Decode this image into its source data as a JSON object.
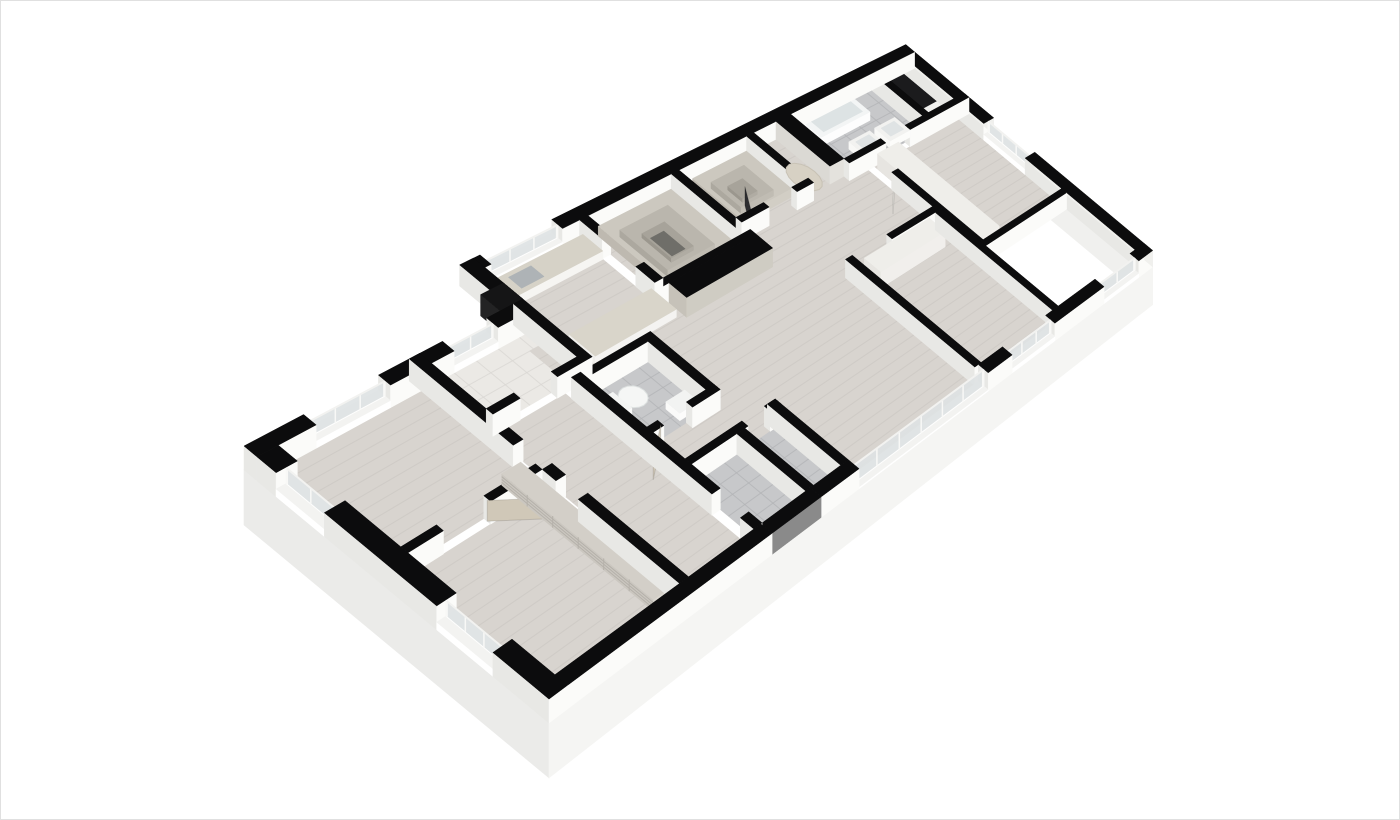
{
  "meta": {
    "title": "3D isometric apartment floor plan render"
  },
  "canvas": {
    "width": 1400,
    "height": 820,
    "background": "#ffffff",
    "frame_color": "#e0e0e0"
  },
  "projection": {
    "matrix": {
      "a": 75.56,
      "b": 40.25,
      "c": 186.7,
      "d": -22.32,
      "e": 33.44,
      "f": 422.3,
      "g": 0.0306,
      "h": 0.00019
    },
    "wall_px": 24,
    "slab_px": 55
  },
  "palette": {
    "cap": "#0c0c0d",
    "faceL": "#e8e8e5",
    "faceF": "#fbfbf9",
    "faceR": "#f0f0ed",
    "wood": "#d8d4cf",
    "plank": "#c6c2bd",
    "tileG": "#c7c8ca",
    "groutG": "#b3b4b6",
    "tileW": "#ebe9e5",
    "groutW": "#d9d7d3",
    "dark": "#1b1b1d",
    "glass": "#dfe3e4",
    "stone": "#d6d2c7",
    "marble": "#d9d5ca",
    "greige": "#c6c2b9",
    "wooddoor": "#d0c8b8",
    "darkpanel": "#2c2c2f"
  },
  "skirts": [
    {
      "name": "slab-left",
      "edge": [
        0,
        1.4,
        0,
        9
      ],
      "fill": "#ebebe9"
    },
    {
      "name": "slab-right",
      "edge": [
        15,
        0,
        15,
        9
      ],
      "fill": "#f0f0ee"
    },
    {
      "name": "slab-front",
      "edge": [
        0,
        9,
        15,
        9
      ],
      "fill": "#f5f5f3"
    }
  ],
  "floors": [
    {
      "name": "bedroom-left-floor",
      "r": [
        0.32,
        1.72,
        2.62,
        4.8
      ],
      "fill": "wood",
      "stripes": 0.27
    },
    {
      "name": "den-floor",
      "r": [
        0.32,
        4.98,
        2.62,
        8.68
      ],
      "fill": "wood",
      "stripes": 0.27
    },
    {
      "name": "laundry-floor",
      "r": [
        2.8,
        1.72,
        4.5,
        3.2
      ],
      "fill": "tileW",
      "grid": 0.4
    },
    {
      "name": "corridor-floor",
      "r": [
        2.8,
        3.38,
        4.15,
        8.68
      ],
      "fill": "wood",
      "stripes": 0.27
    },
    {
      "name": "kitchen-floor",
      "r": [
        4.55,
        0.32,
        6.55,
        2.12
      ],
      "fill": "wood",
      "stripes": 0.27
    },
    {
      "name": "living-floor",
      "r": [
        4.33,
        2.12,
        12.0,
        8.68
      ],
      "fill": "wood",
      "stripes": 0.27
    },
    {
      "name": "closet-a-floor",
      "r": [
        6.73,
        0.32,
        8.55,
        2.57
      ],
      "fill": "wood",
      "stripes": 0.33
    },
    {
      "name": "closet-b-floor",
      "r": [
        8.73,
        0.32,
        10.35,
        2.12
      ],
      "fill": "wood",
      "stripes": 0.33
    },
    {
      "name": "hall-floor",
      "r": [
        10.53,
        0.32,
        11.1,
        2.12
      ],
      "fill": "wood",
      "stripes": 0.33
    },
    {
      "name": "bath-main-floor",
      "r": [
        11.48,
        0.32,
        13.72,
        2.12
      ],
      "fill": "tileG",
      "grid": 0.42
    },
    {
      "name": "void-floor",
      "r": [
        13.9,
        0.32,
        14.68,
        1.5
      ],
      "fill": "dark"
    },
    {
      "name": "bedroom-right-floor",
      "r": [
        12.18,
        2.3,
        14.68,
        6.02
      ],
      "fill": "wood",
      "stripes": 0.27
    },
    {
      "name": "bedroom-mid-floor",
      "r": [
        9.78,
        4.68,
        11.92,
        8.68
      ],
      "fill": "wood",
      "stripes": 0.27
    },
    {
      "name": "bath2-floor",
      "r": [
        4.33,
        3.73,
        5.57,
        5.42
      ],
      "fill": "tileG",
      "grid": 0.35
    },
    {
      "name": "entry1-floor",
      "r": [
        4.33,
        6.68,
        5.3,
        8.68
      ],
      "fill": "tileG",
      "grid": 0.35
    },
    {
      "name": "entry2-floor",
      "r": [
        5.48,
        6.68,
        6.12,
        8.68
      ],
      "fill": "tileG",
      "grid": 0.35
    }
  ],
  "walls": [
    {
      "name": "ext-back-kitchen-left",
      "r": [
        4.55,
        0,
        4.8,
        0.32
      ]
    },
    {
      "name": "ext-back-main",
      "r": [
        6.2,
        0,
        15,
        0.32
      ]
    },
    {
      "name": "ext-backleft-a",
      "r": [
        0,
        1.4,
        0.9,
        1.72
      ]
    },
    {
      "name": "ext-backleft-b",
      "r": [
        2.1,
        1.4,
        3.2,
        1.72
      ]
    },
    {
      "name": "ext-backleft-c",
      "r": [
        4.0,
        1.4,
        4.55,
        1.72
      ]
    },
    {
      "name": "ext-step-wall",
      "r": [
        4.42,
        0,
        4.68,
        1.4
      ]
    },
    {
      "name": "ext-left-a",
      "r": [
        0,
        1.72,
        0.32,
        2.2
      ]
    },
    {
      "name": "ext-left-b",
      "r": [
        0,
        3.4,
        0.32,
        6.2
      ]
    },
    {
      "name": "ext-left-c",
      "r": [
        0,
        7.6,
        0.32,
        9
      ]
    },
    {
      "name": "ext-right-a",
      "r": [
        14.68,
        0.32,
        15,
        3.2
      ],
      "fR": true
    },
    {
      "name": "ext-right-b",
      "r": [
        14.68,
        4.7,
        15,
        9
      ],
      "fR": true
    },
    {
      "name": "ext-front-a",
      "r": [
        0,
        8.68,
        4.3,
        9
      ]
    },
    {
      "name": "entry-door-unit",
      "r": [
        4.3,
        8.68,
        5.4,
        9
      ],
      "fF": "#8a8a8a"
    },
    {
      "name": "ext-front-b",
      "r": [
        5.4,
        8.68,
        6.3,
        9
      ]
    },
    {
      "name": "ext-front-c",
      "r": [
        9.7,
        8.68,
        10.4,
        9
      ]
    },
    {
      "name": "ext-front-d",
      "r": [
        11.7,
        8.68,
        13.3,
        9
      ]
    },
    {
      "name": "ext-front-e",
      "r": [
        14.5,
        8.68,
        15,
        9
      ],
      "fR": true
    },
    {
      "name": "bed1-right-wall",
      "r": [
        2.62,
        1.4,
        2.8,
        4.2
      ]
    },
    {
      "name": "den-right-wall-a",
      "r": [
        2.62,
        4.98,
        2.8,
        5.35
      ]
    },
    {
      "name": "den-right-wall-b",
      "r": [
        2.62,
        5.95,
        2.8,
        8.68
      ]
    },
    {
      "name": "bed1-bottom-a",
      "r": [
        0.32,
        4.8,
        0.9,
        4.98
      ]
    },
    {
      "name": "bed1-bottom-b",
      "r": [
        1.7,
        4.8,
        2.62,
        4.98
      ]
    },
    {
      "name": "laundry-right-wall",
      "r": [
        4.5,
        1.4,
        4.68,
        3.2
      ]
    },
    {
      "name": "laundry-bottom-a",
      "r": [
        2.8,
        3.2,
        3.3,
        3.38
      ]
    },
    {
      "name": "laundry-bottom-b",
      "r": [
        4.0,
        3.2,
        4.68,
        3.38
      ]
    },
    {
      "name": "closet-a-left-a",
      "r": [
        6.55,
        0.32,
        6.73,
        1.0
      ]
    },
    {
      "name": "closet-a-left-b",
      "r": [
        6.55,
        2.0,
        6.73,
        2.57
      ]
    },
    {
      "name": "closet-a-right",
      "r": [
        8.55,
        0.32,
        8.73,
        2.57
      ]
    },
    {
      "name": "closet-a-front",
      "r": [
        6.55,
        2.57,
        8.73,
        2.75
      ]
    },
    {
      "name": "wardrobe-block",
      "r": [
        6.73,
        2.75,
        8.73,
        3.28
      ],
      "fL": "#c6c2b9",
      "fF": "#cfccc3"
    },
    {
      "name": "closet-b-right",
      "r": [
        10.35,
        0.32,
        10.53,
        2.12
      ]
    },
    {
      "name": "closet-b-front-a",
      "r": [
        8.73,
        2.12,
        9.4,
        2.3
      ]
    },
    {
      "name": "closet-b-front-b",
      "r": [
        10.1,
        2.12,
        10.53,
        2.3
      ]
    },
    {
      "name": "hall-cabinet",
      "r": [
        11.1,
        0.32,
        11.48,
        2.12
      ],
      "fL": "#dbd9d4",
      "fF": "#e4e2dd"
    },
    {
      "name": "bath-front-a",
      "r": [
        11.48,
        2.12,
        12.5,
        2.3
      ]
    },
    {
      "name": "bath-front-b",
      "r": [
        13.2,
        2.12,
        15,
        2.3
      ]
    },
    {
      "name": "bath-void-divider",
      "r": [
        13.72,
        0.32,
        13.9,
        2.12
      ]
    },
    {
      "name": "bedR-left-wall",
      "r": [
        12.0,
        3.1,
        12.18,
        6.02
      ]
    },
    {
      "name": "bedR-bottom-wall",
      "r": [
        12.0,
        6.02,
        14.68,
        6.2
      ]
    },
    {
      "name": "bedM-left-wall",
      "r": [
        9.6,
        4.5,
        9.78,
        8.68
      ]
    },
    {
      "name": "bedM-top-wall",
      "r": [
        10.7,
        4.5,
        12.1,
        4.68
      ]
    },
    {
      "name": "bedM-right-wall",
      "r": [
        11.92,
        4.68,
        12.1,
        8.68
      ]
    },
    {
      "name": "bath2-left-wall",
      "r": [
        4.15,
        3.55,
        4.33,
        5.6
      ]
    },
    {
      "name": "bath2-top-wall",
      "r": [
        4.33,
        3.55,
        5.75,
        3.73
      ]
    },
    {
      "name": "bath2-right-wall",
      "r": [
        5.57,
        3.73,
        5.75,
        5.6
      ]
    },
    {
      "name": "bath2-bottom-a",
      "r": [
        4.15,
        5.42,
        4.55,
        5.6
      ]
    },
    {
      "name": "bath2-bottom-b",
      "r": [
        5.15,
        5.42,
        5.75,
        5.6
      ]
    },
    {
      "name": "corridor-right-a",
      "r": [
        4.15,
        5.6,
        4.33,
        7.5
      ]
    },
    {
      "name": "corridor-right-b",
      "r": [
        4.15,
        8.3,
        4.33,
        8.68
      ]
    },
    {
      "name": "entry-top-a",
      "r": [
        4.33,
        6.5,
        5.55,
        6.68
      ]
    },
    {
      "name": "entry-top-b",
      "r": [
        6.05,
        6.5,
        6.3,
        6.68
      ]
    },
    {
      "name": "entry-divider",
      "r": [
        5.3,
        6.68,
        5.48,
        8.68
      ]
    },
    {
      "name": "entry-right",
      "r": [
        6.12,
        6.5,
        6.3,
        8.68
      ]
    }
  ],
  "windows": [
    {
      "name": "kitchen-window",
      "strip": [
        4.8,
        0,
        6.2,
        0.32
      ],
      "sill": 0.3,
      "nm": 3
    },
    {
      "name": "bed1-window",
      "strip": [
        0.9,
        1.4,
        2.1,
        1.72
      ],
      "sill": 0.28,
      "nm": 3
    },
    {
      "name": "laundry-window",
      "strip": [
        3.2,
        1.4,
        4.0,
        1.72
      ],
      "sill": 0.3,
      "nm": 2
    },
    {
      "name": "left-window",
      "strip": [
        0,
        2.2,
        0.32,
        3.4
      ],
      "sill": 0.28,
      "nm": 2
    },
    {
      "name": "den-window",
      "strip": [
        0,
        6.2,
        0.32,
        7.6
      ],
      "sill": 0.28,
      "nm": 3
    },
    {
      "name": "bedR-window-east",
      "strip": [
        14.68,
        3.2,
        15,
        4.7
      ],
      "sill": 0.3,
      "nm": 3
    },
    {
      "name": "living-glazing",
      "strip": [
        6.3,
        8.68,
        9.7,
        9
      ],
      "sill": 0.05,
      "nm": 6
    },
    {
      "name": "bedM-window",
      "strip": [
        10.4,
        8.68,
        11.7,
        9
      ],
      "sill": 0.22,
      "nm": 3
    },
    {
      "name": "bedR-window-south",
      "strip": [
        13.3,
        8.68,
        14.5,
        9
      ],
      "sill": 0.22,
      "nm": 2
    }
  ],
  "boxes": [
    {
      "name": "kitchen-counter",
      "r": [
        4.68,
        0.42,
        6.55,
        1.02
      ],
      "m": 0.42,
      "cap": "#d6d2c7",
      "fL": "#f1f0ed",
      "fF": "#f6f5f2"
    },
    {
      "name": "cooktop",
      "r": [
        5.85,
        0.5,
        6.42,
        0.95
      ],
      "m": 0.45,
      "cap": "#2e2e30",
      "flat": true
    },
    {
      "name": "kitchen-sink",
      "r": [
        4.98,
        0.54,
        5.42,
        0.92
      ],
      "m": 0.45,
      "cap": "#aeb3b6",
      "flat": true
    },
    {
      "name": "kitchen-island",
      "r": [
        4.9,
        2.4,
        6.6,
        3.15
      ],
      "m": 0.4,
      "cap": "#d9d5ca",
      "fL": "#efeeeb",
      "fF": "#f4f3f1"
    },
    {
      "name": "bathtub",
      "r": [
        11.7,
        0.45,
        13.05,
        1.08
      ],
      "m": 0.5,
      "cap": "#f3f5f5",
      "fL": "#f9fafa",
      "fF": "#fdfdfd"
    },
    {
      "name": "bathtub-basin",
      "r": [
        11.84,
        0.56,
        12.92,
        0.98
      ],
      "m": 0.52,
      "cap": "#dde3e4",
      "flat": true
    },
    {
      "name": "vanity-1",
      "r": [
        12.1,
        1.52,
        12.68,
        2.06
      ],
      "m": 0.42,
      "cap": "#f2f2f0",
      "fL": "#f8f8f6",
      "fF": "#fcfcfa"
    },
    {
      "name": "vanity-sink-1",
      "r": [
        12.2,
        1.62,
        12.58,
        1.96
      ],
      "m": 0.44,
      "cap": "#dfe3e4",
      "flat": true
    },
    {
      "name": "vanity-2",
      "r": [
        12.82,
        1.52,
        13.4,
        2.06
      ],
      "m": 0.42,
      "cap": "#f2f2f0",
      "fL": "#f8f8f6",
      "fF": "#fcfcfa"
    },
    {
      "name": "vanity-sink-2",
      "r": [
        12.92,
        1.62,
        13.3,
        1.96
      ],
      "m": 0.44,
      "cap": "#dfe3e4",
      "flat": true
    },
    {
      "name": "bedM-closet",
      "r": [
        9.95,
        4.68,
        11.75,
        5.22
      ],
      "m": 0.88,
      "cap": "#efeeea",
      "fL": "#e7e5e1",
      "fF": "#f1efec"
    },
    {
      "name": "bedR-closet",
      "r": [
        12.18,
        2.4,
        12.78,
        5.9
      ],
      "m": 0.88,
      "cap": "#efeeea",
      "fL": "#e7e5e1",
      "fF": "#f1efec"
    },
    {
      "name": "closet-a-shelf-outer",
      "r": [
        6.85,
        0.45,
        8.45,
        2.45
      ],
      "m": 0.5,
      "cap": "#ccc8bf",
      "fL": "#beb9b0",
      "fF": "#d2cec5",
      "z": 1
    },
    {
      "name": "closet-a-shelf-mid",
      "r": [
        7.12,
        0.72,
        8.18,
        2.18
      ],
      "m": 0.36,
      "cap": "#bab6ad",
      "fL": "#aca89f",
      "fF": "#c0bcb3",
      "z": 2
    },
    {
      "name": "closet-a-shelf-inner",
      "r": [
        7.4,
        1.0,
        7.9,
        1.9
      ],
      "m": 0.22,
      "cap": "#a7a39a",
      "fL": "#9b978e",
      "fF": "#b0aca3",
      "z": 3
    },
    {
      "name": "closet-a-pit",
      "r": [
        7.5,
        1.12,
        7.8,
        1.78
      ],
      "m": 0.03,
      "cap": "#6f6e69",
      "flat": true,
      "z": 4
    },
    {
      "name": "closet-b-shelf-outer",
      "r": [
        8.95,
        0.45,
        10.25,
        1.92
      ],
      "m": 0.48,
      "cap": "#ccc8bf",
      "fL": "#beb9b0",
      "fF": "#d2cec5",
      "z": 1
    },
    {
      "name": "closet-b-shelf-mid",
      "r": [
        9.2,
        0.7,
        10.0,
        1.66
      ],
      "m": 0.34,
      "cap": "#bab6ad",
      "fL": "#aca89f",
      "fF": "#c0bcb3",
      "z": 2
    },
    {
      "name": "closet-b-shelf-inner",
      "r": [
        9.42,
        0.94,
        9.78,
        1.42
      ],
      "m": 0.2,
      "cap": "#a7a39a",
      "fL": "#9b978e",
      "fF": "#b0aca3",
      "z": 3
    },
    {
      "name": "den-bookshelf",
      "r": [
        2.28,
        4.4,
        2.62,
        8.45
      ],
      "m": 0.52,
      "cap": "#d3cfc8",
      "fL": "#cbc7c0",
      "fF": "#dbd7d0",
      "lines": true
    },
    {
      "name": "toilet-tank",
      "r": [
        4.4,
        4.08,
        4.6,
        4.62
      ],
      "m": 0.4,
      "cap": "#f3f4f3",
      "fL": "#fbfbfa",
      "fF": "#fdfdfc"
    },
    {
      "name": "bath2-sink",
      "r": [
        5.1,
        4.9,
        5.5,
        5.3
      ],
      "m": 0.36,
      "cap": "#f2f3f2",
      "fL": "#fafaf9",
      "fF": "#fcfcfb"
    },
    {
      "name": "dark-shaft-bump",
      "r": [
        4.25,
        0.85,
        4.68,
        1.4
      ],
      "m": 1,
      "cap": "#151516",
      "fL": "#232324",
      "fF": "#2e2e30"
    }
  ],
  "ellipses": [
    {
      "name": "toilet-bowl",
      "c": [
        4.82,
        4.35
      ],
      "ru": 0.22,
      "rv": 0.3,
      "m": 0.24,
      "fill": "#f5f6f5",
      "stroke": "#dde1e0"
    },
    {
      "name": "pebble-rug",
      "c": [
        10.82,
        1.62
      ],
      "ru": 0.27,
      "rv": 0.5,
      "m": 0.03,
      "fill": "#d7d1c4",
      "stroke": "#c8c2b5"
    }
  ],
  "doors": [
    {
      "name": "bath2-door",
      "h": [
        4.55,
        5.51
      ],
      "t": [
        3.97,
        6.1
      ],
      "m": 0.92,
      "fill": "#d0c8b8"
    },
    {
      "name": "bed1-door",
      "h": [
        1.7,
        4.89
      ],
      "t": [
        2.28,
        5.48
      ],
      "m": 0.92,
      "fill": "#d0c8b8"
    },
    {
      "name": "bedR-door",
      "h": [
        12.09,
        3.1
      ],
      "t": [
        11.54,
        3.7
      ],
      "m": 0.92,
      "fill": "#e9e7e2"
    },
    {
      "name": "mirror-panel",
      "h": [
        8.98,
        2.32
      ],
      "t": [
        9.4,
        1.52
      ],
      "m": 1.02,
      "fill": "#2c2c2f"
    }
  ]
}
